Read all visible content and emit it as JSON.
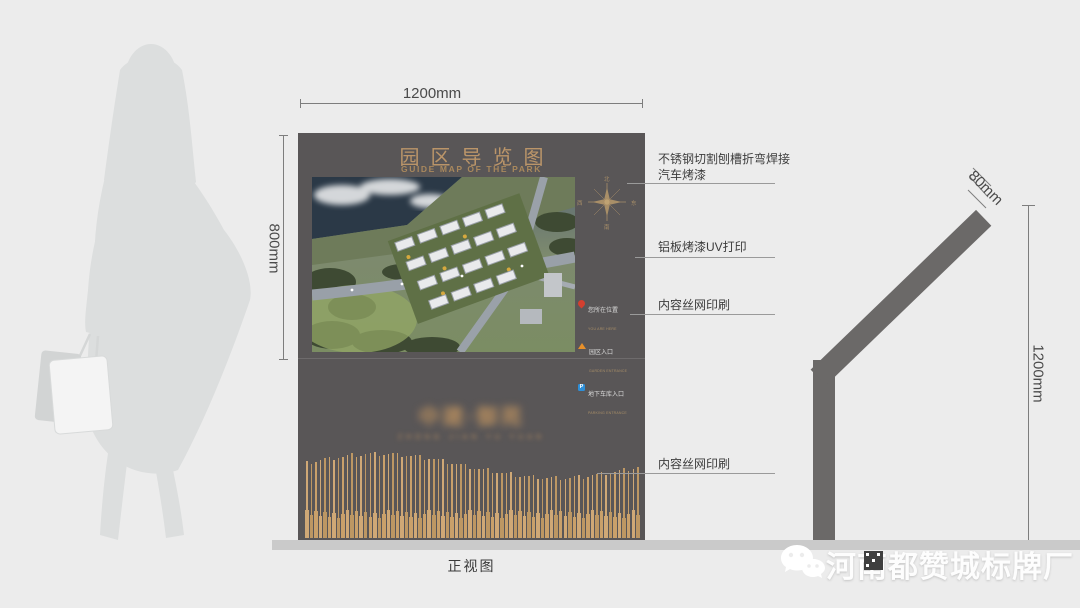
{
  "front_view": {
    "title": "园区导览图",
    "subtitle": "GUIDE MAP OF THE PARK",
    "width_dim": "1200mm",
    "height_dim": "800mm",
    "caption": "正视图",
    "logo_text": "中建·御苑",
    "logo_subtext": "ZHONG JIAN YU YUAN",
    "board_color": "#595657",
    "gold_color": "#bb9569",
    "compass": {
      "north": "北",
      "south": "南",
      "west": "西",
      "east": "东"
    },
    "legend": [
      {
        "icon": "location-pin-icon",
        "color": "#d43f2f",
        "label": "您所在位置",
        "sublabel": "YOU ARE HERE"
      },
      {
        "icon": "entrance-triangle-icon",
        "color": "#e8902a",
        "label": "园区入口",
        "sublabel": "GARDEN ENTRANCE"
      },
      {
        "icon": "parking-icon",
        "color": "#2e8fd8",
        "label": "地下车库入口",
        "sublabel": "PARKING ENTRANCE"
      }
    ],
    "wave": {
      "bars": 74,
      "colors": [
        "#cfa876",
        "#bd9763",
        "#c9a06a"
      ]
    }
  },
  "callouts": [
    {
      "line1": "不锈钢切割刨槽折弯焊接",
      "line2": "汽车烤漆"
    },
    {
      "line1": "铝板烤漆UV打印",
      "line2": ""
    },
    {
      "line1": "内容丝网印刷",
      "line2": ""
    },
    {
      "line1": "内容丝网印刷",
      "line2": ""
    }
  ],
  "side_view": {
    "thickness_dim": "80mm",
    "height_dim": "1200mm",
    "pole_color": "#6b6968"
  },
  "watermark": {
    "icon": "wechat-icon",
    "text": "河南都赞城标牌厂"
  }
}
